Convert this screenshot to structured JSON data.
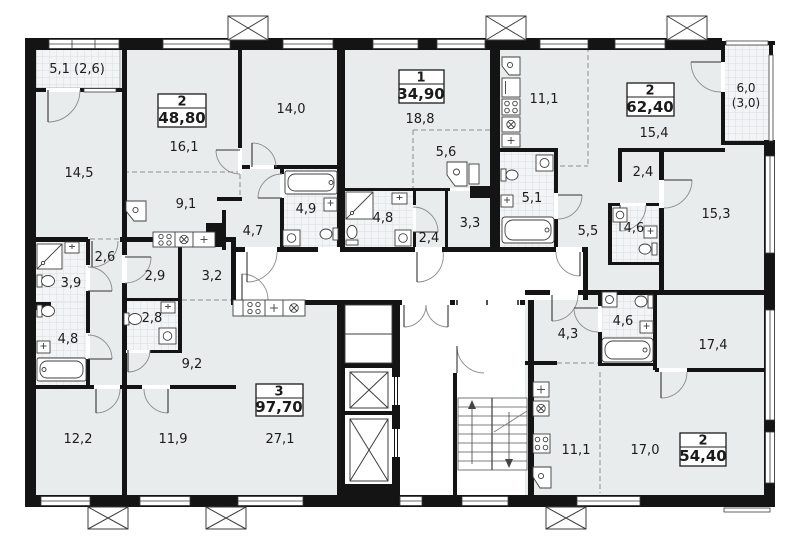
{
  "colors": {
    "wall": "#141414",
    "room_fill": "#e8eced",
    "wet_fill": "#f2f4f5",
    "tile_line": "#d8dee1",
    "corridor_fill": "#ffffff",
    "outline": "#3c3c3c"
  },
  "apartments": [
    {
      "rooms": "2",
      "area": "48,80"
    },
    {
      "rooms": "1",
      "area": "34,90"
    },
    {
      "rooms": "2",
      "area": "62,40"
    },
    {
      "rooms": "3",
      "area": "97,70"
    },
    {
      "rooms": "2",
      "area": "54,40"
    }
  ],
  "room_labels": [
    {
      "text": "5,1 (2,6)"
    },
    {
      "text": "14,5"
    },
    {
      "text": "16,1"
    },
    {
      "text": "9,1"
    },
    {
      "text": "4,7"
    },
    {
      "text": "14,0"
    },
    {
      "text": "4,9"
    },
    {
      "text": "18,8"
    },
    {
      "text": "5,6"
    },
    {
      "text": "4,8"
    },
    {
      "text": "2,4"
    },
    {
      "text": "3,3"
    },
    {
      "text": "11,1"
    },
    {
      "text": "15,4"
    },
    {
      "text": "2,4"
    },
    {
      "text": "5,1"
    },
    {
      "text": "5,5"
    },
    {
      "text": "4,6"
    },
    {
      "text": "15,3"
    },
    {
      "text": "2,6"
    },
    {
      "text": "2,9"
    },
    {
      "text": "3,2"
    },
    {
      "text": "3,9"
    },
    {
      "text": "2,8"
    },
    {
      "text": "4,8"
    },
    {
      "text": "9,2"
    },
    {
      "text": "12,2"
    },
    {
      "text": "11,9"
    },
    {
      "text": "27,1"
    },
    {
      "text": "4,3"
    },
    {
      "text": "4,6"
    },
    {
      "text": "17,4"
    },
    {
      "text": "11,1"
    },
    {
      "text": "17,0"
    },
    {
      "text": "6,0"
    },
    {
      "text": "(3,0)"
    }
  ]
}
